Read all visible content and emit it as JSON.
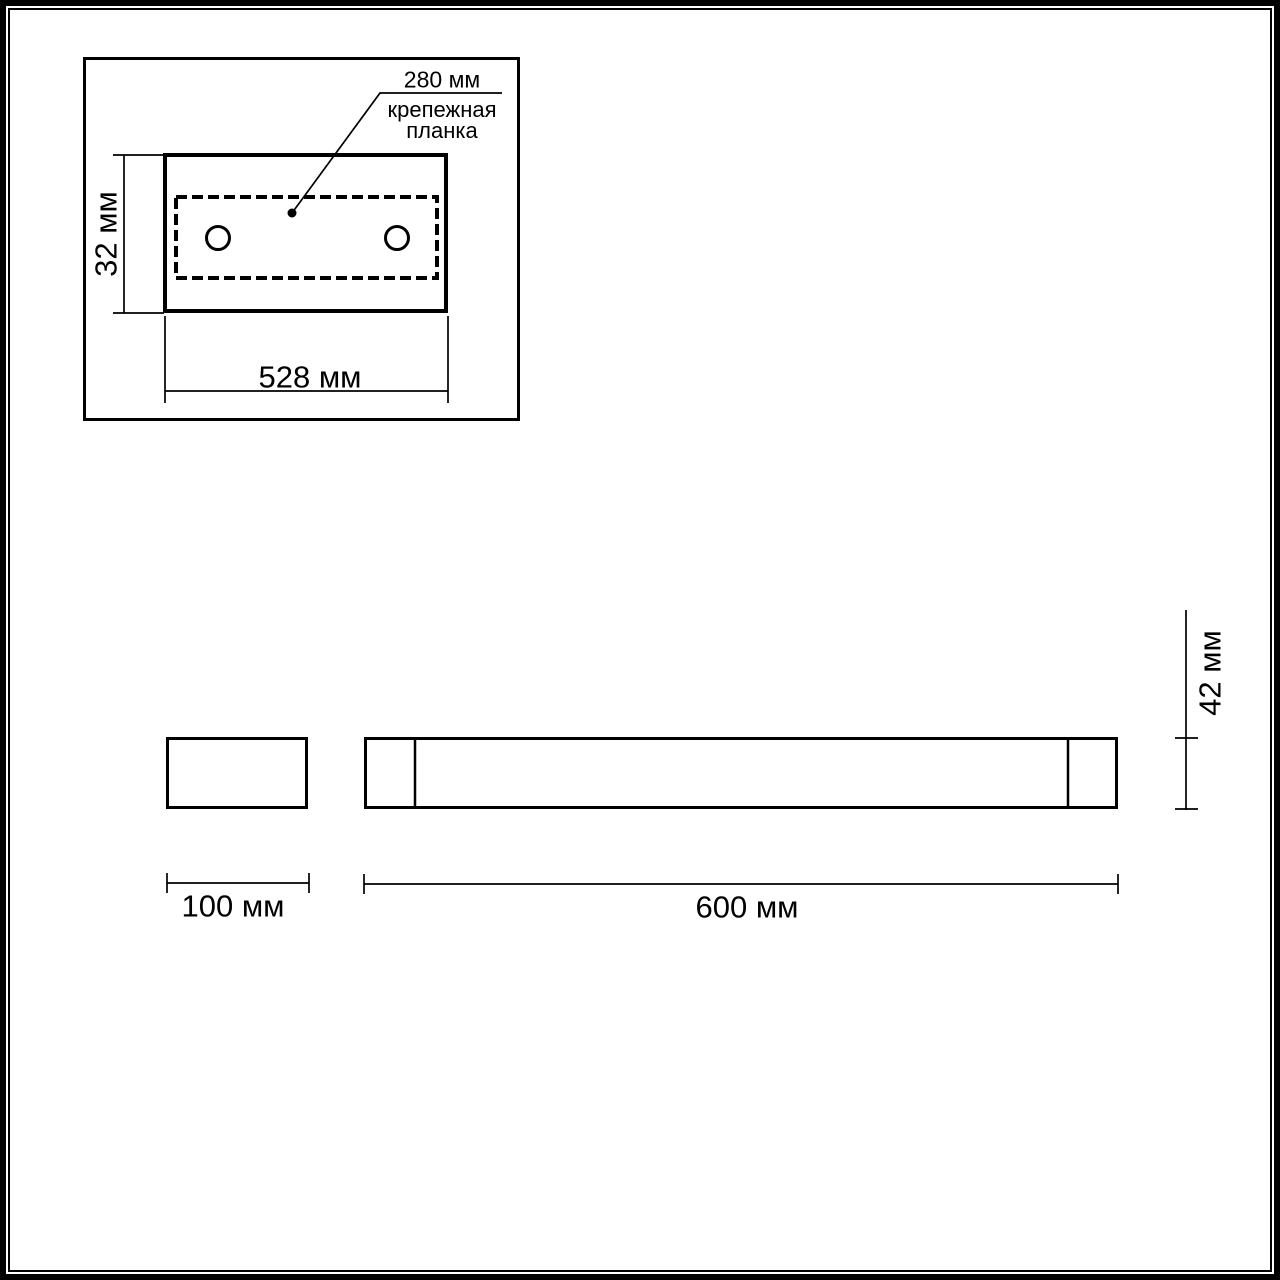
{
  "page": {
    "background": "#ffffff",
    "line_color": "#000000",
    "type_label": "dimension drawing"
  },
  "top_view": {
    "hole_spacing_label": "280 мм",
    "mounting_plate_label": {
      "line1": "крепежная",
      "line2": "планка"
    },
    "height_label": "32 мм",
    "width_label": "528 мм"
  },
  "front_view": {
    "end_cap_width_label": "100 мм",
    "body_length_label": "600 мм",
    "body_height_label": "42 мм"
  }
}
